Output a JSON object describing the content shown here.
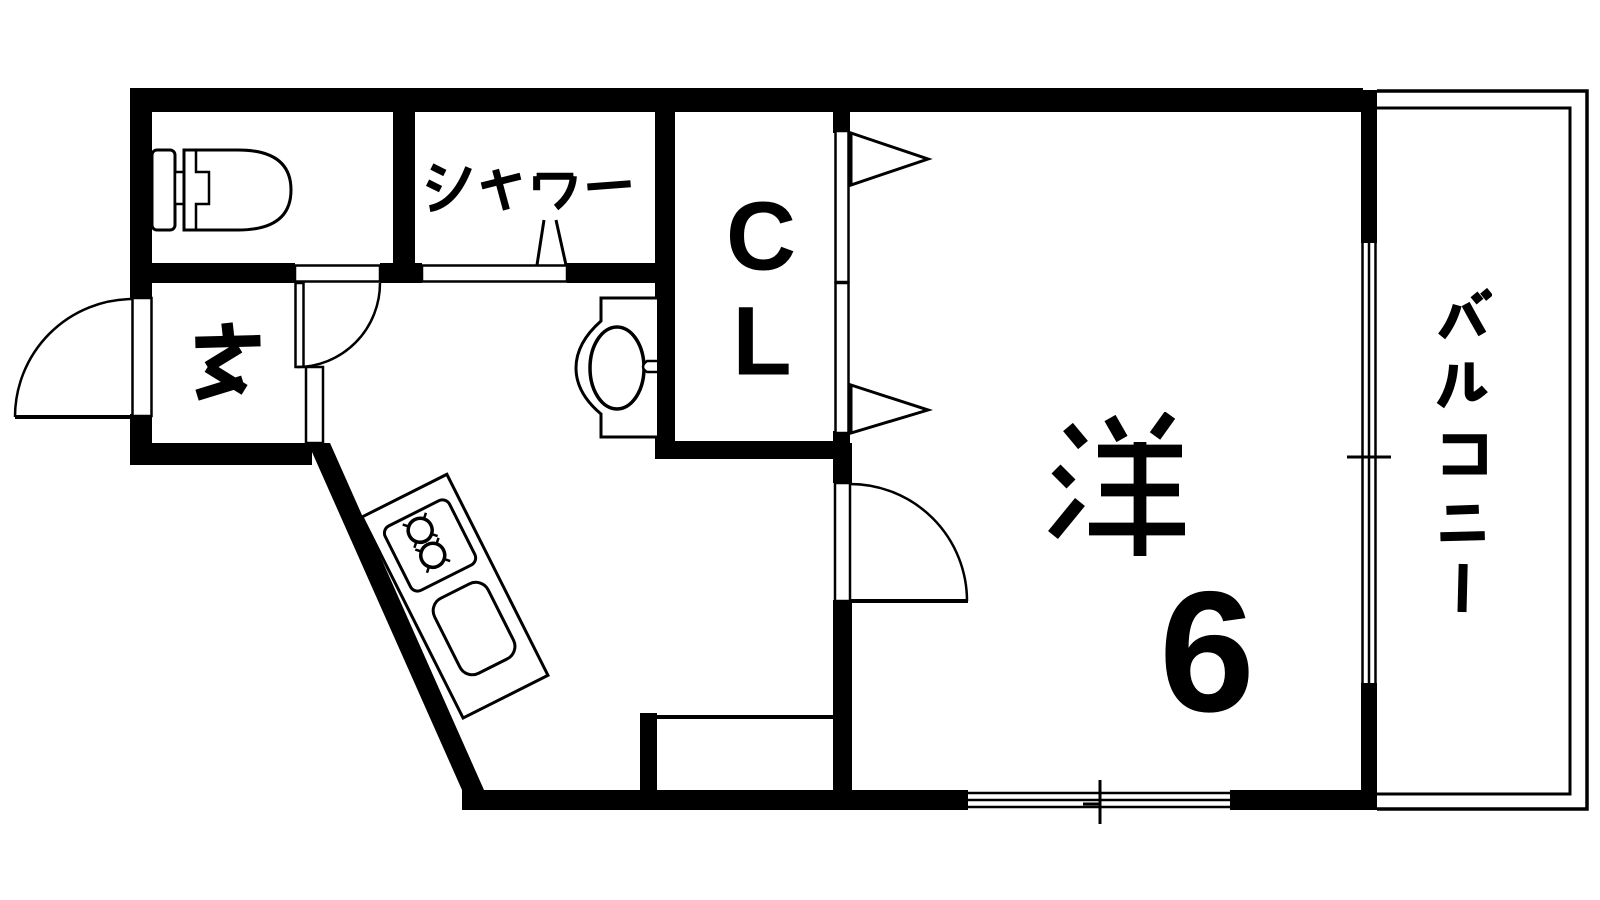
{
  "plan": {
    "background_color": "#ffffff",
    "wall_color": "#000000",
    "rooms": {
      "toilet": {
        "name": "toilet-room"
      },
      "shower": {
        "label": "シャワー"
      },
      "closet": {
        "label": "CL",
        "lines": [
          "C",
          "L"
        ]
      },
      "entrance": {
        "label": "玄"
      },
      "western_room": {
        "label": "洋",
        "size": "6"
      },
      "kitchen": {
        "name": "kitchen-area"
      },
      "balcony": {
        "label": "バルコニー"
      }
    },
    "fixtures": {
      "toilet": "toilet-icon",
      "washbasin": "washbasin-icon",
      "stove": "two-burner-stove-icon",
      "sink": "kitchen-sink-icon"
    }
  }
}
